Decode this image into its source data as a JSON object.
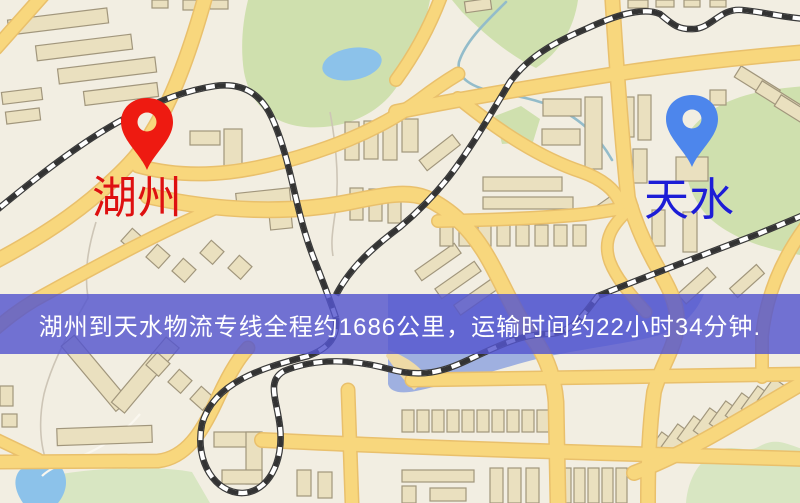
{
  "markers": {
    "origin": {
      "label": "湖州",
      "pin_color": "#ee1a11",
      "label_color": "#de1010"
    },
    "destination": {
      "label": "天水",
      "pin_color": "#4d86ec",
      "label_color": "#1d1dd6"
    }
  },
  "banner": {
    "text": "湖州到天水物流专线全程约1686公里，运输时间约22小时34分钟.",
    "background": "#5456ce",
    "text_color": "#ffffff"
  },
  "route": {
    "origin": "湖州",
    "destination": "天水",
    "distance_text": "约1686公里",
    "duration_text": "约22小时34分钟"
  },
  "map_palette": {
    "background": "#f2eee2",
    "road": "#f8d77d",
    "building": "#eae0bf",
    "park_green": "#cfe0ae",
    "water": "#8cc2ea",
    "railway": "#3a3a3a"
  }
}
